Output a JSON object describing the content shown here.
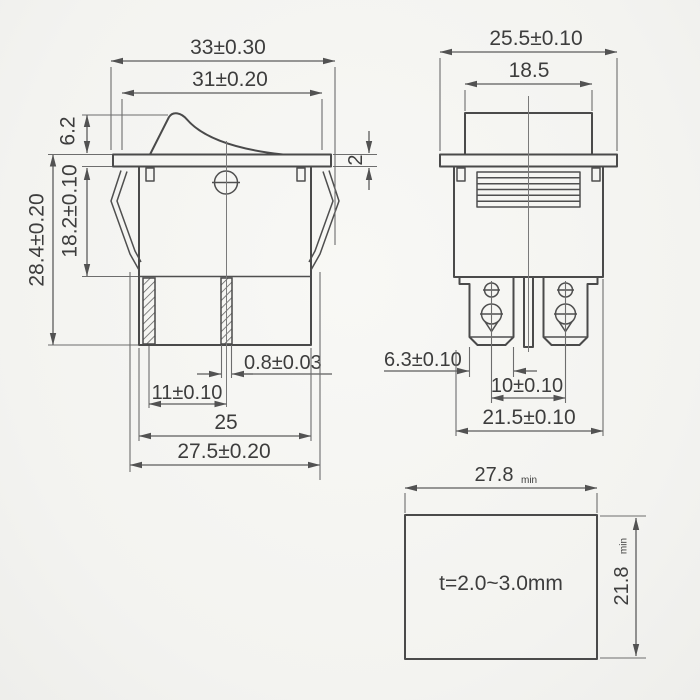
{
  "drawing": {
    "front_view": {
      "dim_total_width": "33±0.30",
      "dim_rocker_width": "31±0.20",
      "dim_rocker_height": "6.2",
      "dim_body_height": "18.2±0.10",
      "dim_overall_height": "28.4±0.20",
      "dim_flange_thickness": "2",
      "dim_terminal_thickness": "0.8±0.03",
      "dim_terminal_pitch": "11±0.10",
      "dim_base_width": "25",
      "dim_body_width": "27.5±0.20"
    },
    "side_view": {
      "dim_flange_width": "25.5±0.10",
      "dim_rocker_width": "18.5",
      "dim_terminal_width": "6.3±0.10",
      "dim_terminal_pitch": "10±0.10",
      "dim_body_width": "21.5±0.10"
    },
    "panel_cutout": {
      "dim_width": "27.8",
      "dim_width_suffix": "min",
      "dim_height": "21.8",
      "dim_height_suffix": "min",
      "thickness_note": "t=2.0~3.0mm"
    }
  }
}
